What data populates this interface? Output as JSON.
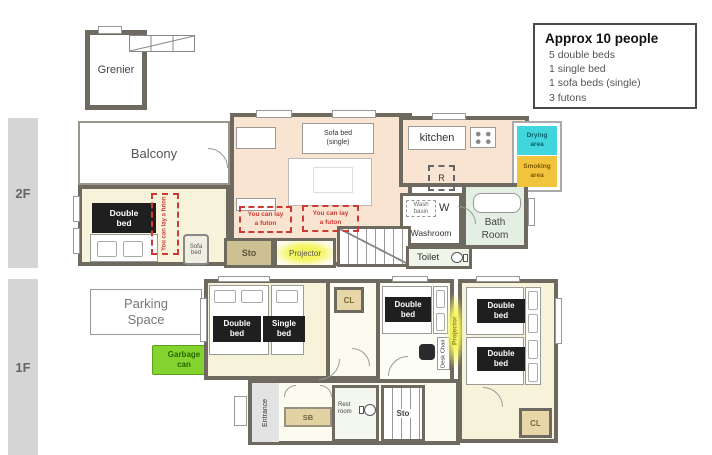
{
  "info_box": {
    "title": "Approx 10 people",
    "items": [
      "5 double beds",
      "1 single bed",
      "1 sofa beds (single)",
      "3 futons"
    ]
  },
  "floor_labels": {
    "second": "2F",
    "first": "1F"
  },
  "attic": {
    "label": "Grenier"
  },
  "f2": {
    "balcony": "Balcony",
    "bedroom": {
      "double_bed": "Double bed",
      "futon_note": "You can lay a futon",
      "sofa_bed": "Sofa bed"
    },
    "living": {
      "sofa_bed_single": "Sofa bed (single)",
      "futon_note_left": "You can lay a futon",
      "futon_note_right": "You can lay a futon",
      "projector": "Projector",
      "storage": "Sto"
    },
    "kitchen": {
      "label": "kitchen",
      "fridge": "R"
    },
    "outdoor": {
      "drying": "Drying area",
      "smoking": "Smoking area"
    },
    "sanitary": {
      "wash_basin": "Wash basin",
      "washer": "W",
      "washroom": "Washroom",
      "bath": "Bath Room",
      "toilet": "Toilet"
    }
  },
  "f1": {
    "parking": "Parking Space",
    "garbage": "Garbage can",
    "bedroom_left": {
      "double_bed": "Double bed",
      "single_bed": "Single bed",
      "closet": "CL"
    },
    "bedroom_mid": {
      "double_bed": "Double bed",
      "desk_chair": "Desk Chair",
      "projector": "Projector"
    },
    "bedroom_right": {
      "double_bed_upper": "Double bed",
      "double_bed_lower": "Double bed",
      "closet": "CL"
    },
    "entry": {
      "entrance": "Entrance",
      "shoe_box": "SB",
      "rest_room": "Rest room",
      "storage": "Sto"
    }
  },
  "icons": {
    "ladder": "ladder-icon",
    "stove": "stove-icon",
    "toilet": "toilet-icon",
    "bathtub": "bathtub-icon",
    "stairs": "stairs-icon",
    "door": "door-arc-icon",
    "window": "window-icon"
  },
  "colors": {
    "wall": "#6f6a60",
    "cream": "#f6f3da",
    "peach": "#f9e4d1",
    "bath-green": "#e3efe2",
    "tan": "#cdc093",
    "closet-tan": "#e7d7a8",
    "cyan": "#41d6de",
    "smoking-yellow": "#f2c43d",
    "garbage-green": "#84d430",
    "projector-yellow": "#f5f560",
    "bed-black": "#1f1f1f",
    "futon-red": "#cc3b33",
    "bar-gray": "#d5d5d5"
  }
}
